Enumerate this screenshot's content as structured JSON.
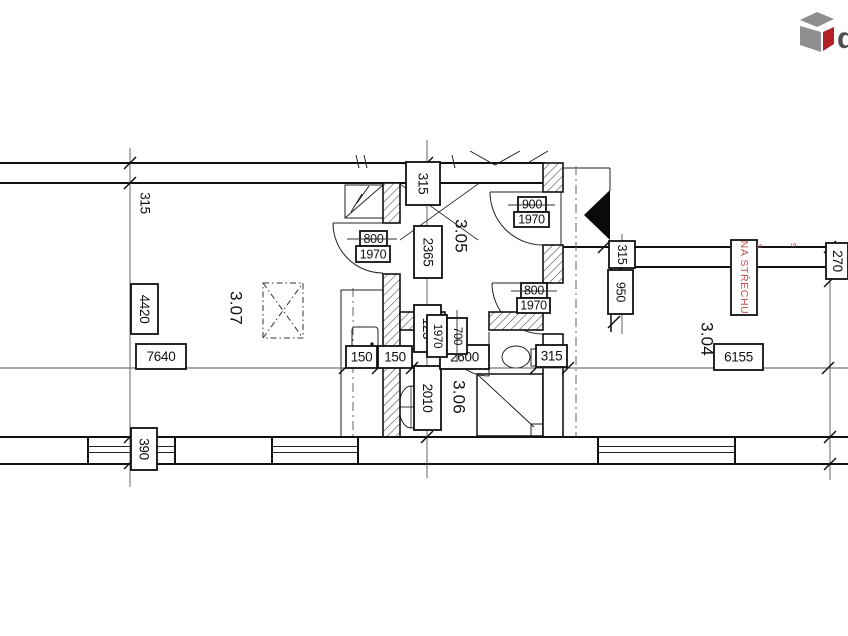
{
  "drawing": {
    "type": "floor-plan-fragment"
  },
  "logo": {
    "letter": "d",
    "gray": "#8e8e8e",
    "red": "#b22028"
  },
  "rooms": {
    "living": "3.07",
    "hall": "3.05",
    "bathroom": "3.06",
    "attic": "3.04"
  },
  "dims": {
    "left_wall": "315",
    "left_height": "4420",
    "left_width": "7640",
    "left_sill": "390",
    "hall_wall_top": "315",
    "hall_length": "2365",
    "hall_niche": "125",
    "bath_length": "2010",
    "counter_left": "150",
    "counter_right": "150",
    "bath_width": "2600",
    "bath_wall": "315",
    "shaft_wall": "315",
    "shaft_opening": "950",
    "attic_width": "6155",
    "right_edge": "270"
  },
  "doors": {
    "living": {
      "width": "800",
      "height": "1970"
    },
    "hall_upper": {
      "width": "900",
      "height": "1970"
    },
    "hall_lower": {
      "width": "800",
      "height": "1970"
    },
    "bathroom": {
      "width": "700",
      "height": "1970"
    }
  },
  "annotations": {
    "roof_access": "NA STŘECHU",
    "mark_left": "s",
    "mark_right": "s"
  },
  "colors": {
    "ink": "#1a1a1a",
    "accent_red": "#c4524d",
    "logo_gray": "#8e8e8e",
    "logo_red": "#b22028"
  }
}
